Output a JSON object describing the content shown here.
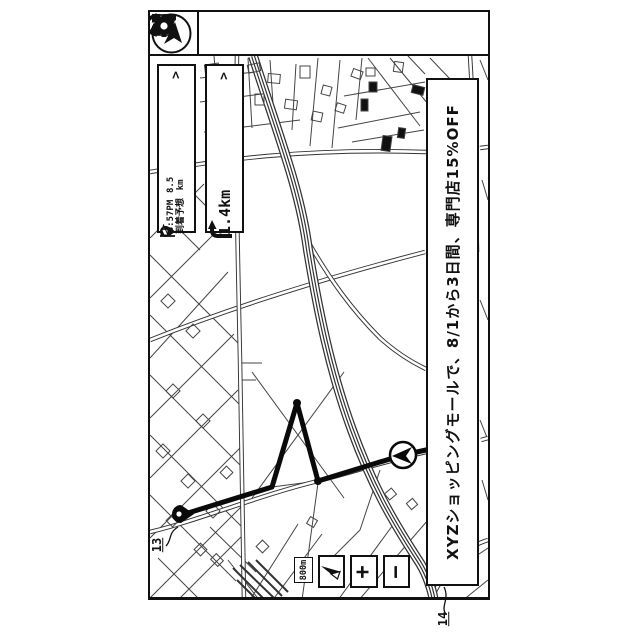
{
  "device": {
    "toolbar": {
      "nav_icon": "navigation-arrow",
      "menu_icons": [
        "route-icon",
        "phone-icon",
        "book-icon",
        "apps-grid-icon",
        "settings-gear-icon"
      ]
    },
    "arrival_panel": {
      "pin_icon": "destination-pin",
      "time": "3:57PM",
      "label": "到着予想",
      "distance": "8.5",
      "unit": "km",
      "flag_icon": "goal-flag",
      "chevron": ">"
    },
    "turn_panel": {
      "turn_icon": "turn-right-arrow",
      "distance": "1.4km",
      "chevron": ">"
    },
    "ad_banner": {
      "text": "XYZショッピングモールで、8/1から3日間、専門店15%OFF"
    },
    "map_controls": {
      "scale_label": "800m",
      "compass_icon": "compass-needle",
      "zoom_in": "+",
      "zoom_out": "−"
    },
    "map": {
      "route_points": "188,513 272,487 297,403 318,481 403,455 426,450",
      "guide_point_1": {
        "x": 297,
        "y": 403
      },
      "guide_point_2": {
        "x": 318,
        "y": 481
      },
      "vehicle": {
        "x": 403,
        "y": 455
      },
      "destination": {
        "x": 184,
        "y": 514
      }
    }
  },
  "annotations": {
    "ref13": "13",
    "ref14": "14"
  },
  "colors": {
    "ink": "#111111",
    "road": "#444444",
    "bg": "#ffffff"
  }
}
